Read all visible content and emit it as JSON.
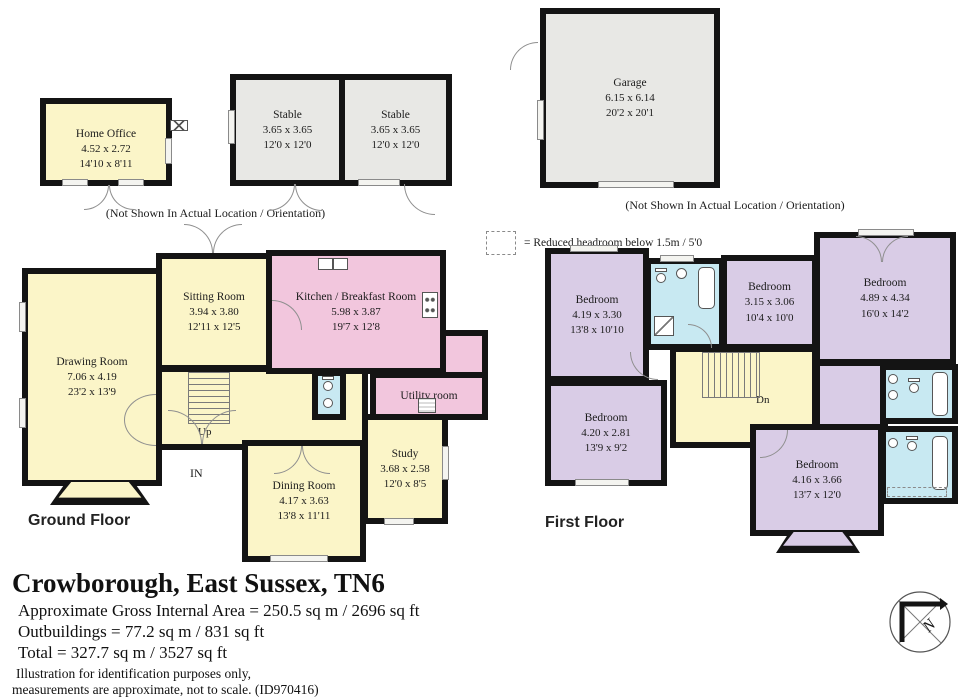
{
  "colors": {
    "room_yellow": "#fbf5c8",
    "room_pink": "#f2c6dd",
    "room_lavender": "#d9cce6",
    "room_blue": "#c8e9f2",
    "room_gray": "#e8e8e5",
    "wall": "#141414"
  },
  "outbuildings": {
    "note": "(Not Shown In Actual Location / Orientation)",
    "home_office": {
      "name": "Home Office",
      "metric": "4.52 x 2.72",
      "imperial": "14'10 x 8'11"
    },
    "stable_1": {
      "name": "Stable",
      "metric": "3.65 x 3.65",
      "imperial": "12'0 x 12'0"
    },
    "stable_2": {
      "name": "Stable",
      "metric": "3.65 x 3.65",
      "imperial": "12'0 x 12'0"
    },
    "garage": {
      "name": "Garage",
      "metric": "6.15 x 6.14",
      "imperial": "20'2 x 20'1"
    }
  },
  "legend": {
    "reduced_headroom": "= Reduced headroom below 1.5m / 5'0"
  },
  "ground_floor": {
    "label": "Ground Floor",
    "stairs_label": "Up",
    "entrance_label": "IN",
    "rooms": {
      "drawing_room": {
        "name": "Drawing Room",
        "metric": "7.06 x 4.19",
        "imperial": "23'2 x 13'9"
      },
      "sitting_room": {
        "name": "Sitting Room",
        "metric": "3.94 x 3.80",
        "imperial": "12'11 x 12'5"
      },
      "kitchen": {
        "name": "Kitchen / Breakfast Room",
        "metric": "5.98 x 3.87",
        "imperial": "19'7 x 12'8"
      },
      "utility": {
        "name": "Utility room"
      },
      "dining_room": {
        "name": "Dining Room",
        "metric": "4.17 x 3.63",
        "imperial": "13'8 x 11'11"
      },
      "study": {
        "name": "Study",
        "metric": "3.68 x 2.58",
        "imperial": "12'0 x 8'5"
      }
    }
  },
  "first_floor": {
    "label": "First Floor",
    "stairs_label": "Dn",
    "rooms": {
      "bedroom_1": {
        "name": "Bedroom",
        "metric": "4.19 x 3.30",
        "imperial": "13'8 x 10'10"
      },
      "bedroom_2": {
        "name": "Bedroom",
        "metric": "3.15 x 3.06",
        "imperial": "10'4 x 10'0"
      },
      "bedroom_3": {
        "name": "Bedroom",
        "metric": "4.89 x 4.34",
        "imperial": "16'0 x 14'2"
      },
      "bedroom_4": {
        "name": "Bedroom",
        "metric": "4.20 x 2.81",
        "imperial": "13'9 x 9'2"
      },
      "bedroom_5": {
        "name": "Bedroom",
        "metric": "4.16 x 3.66",
        "imperial": "13'7 x 12'0"
      }
    }
  },
  "title_block": {
    "title": "Crowborough, East Sussex, TN6",
    "area_line": "Approximate Gross Internal Area = 250.5 sq m / 2696 sq ft",
    "outbuildings_line": "Outbuildings = 77.2 sq m / 831 sq ft",
    "total_line": "Total = 327.7 sq m / 3527 sq ft",
    "disclaimer_line1": "Illustration for identification purposes only,",
    "disclaimer_line2": "measurements are approximate, not to scale. (ID970416)"
  },
  "compass": {
    "north_label": "N"
  }
}
